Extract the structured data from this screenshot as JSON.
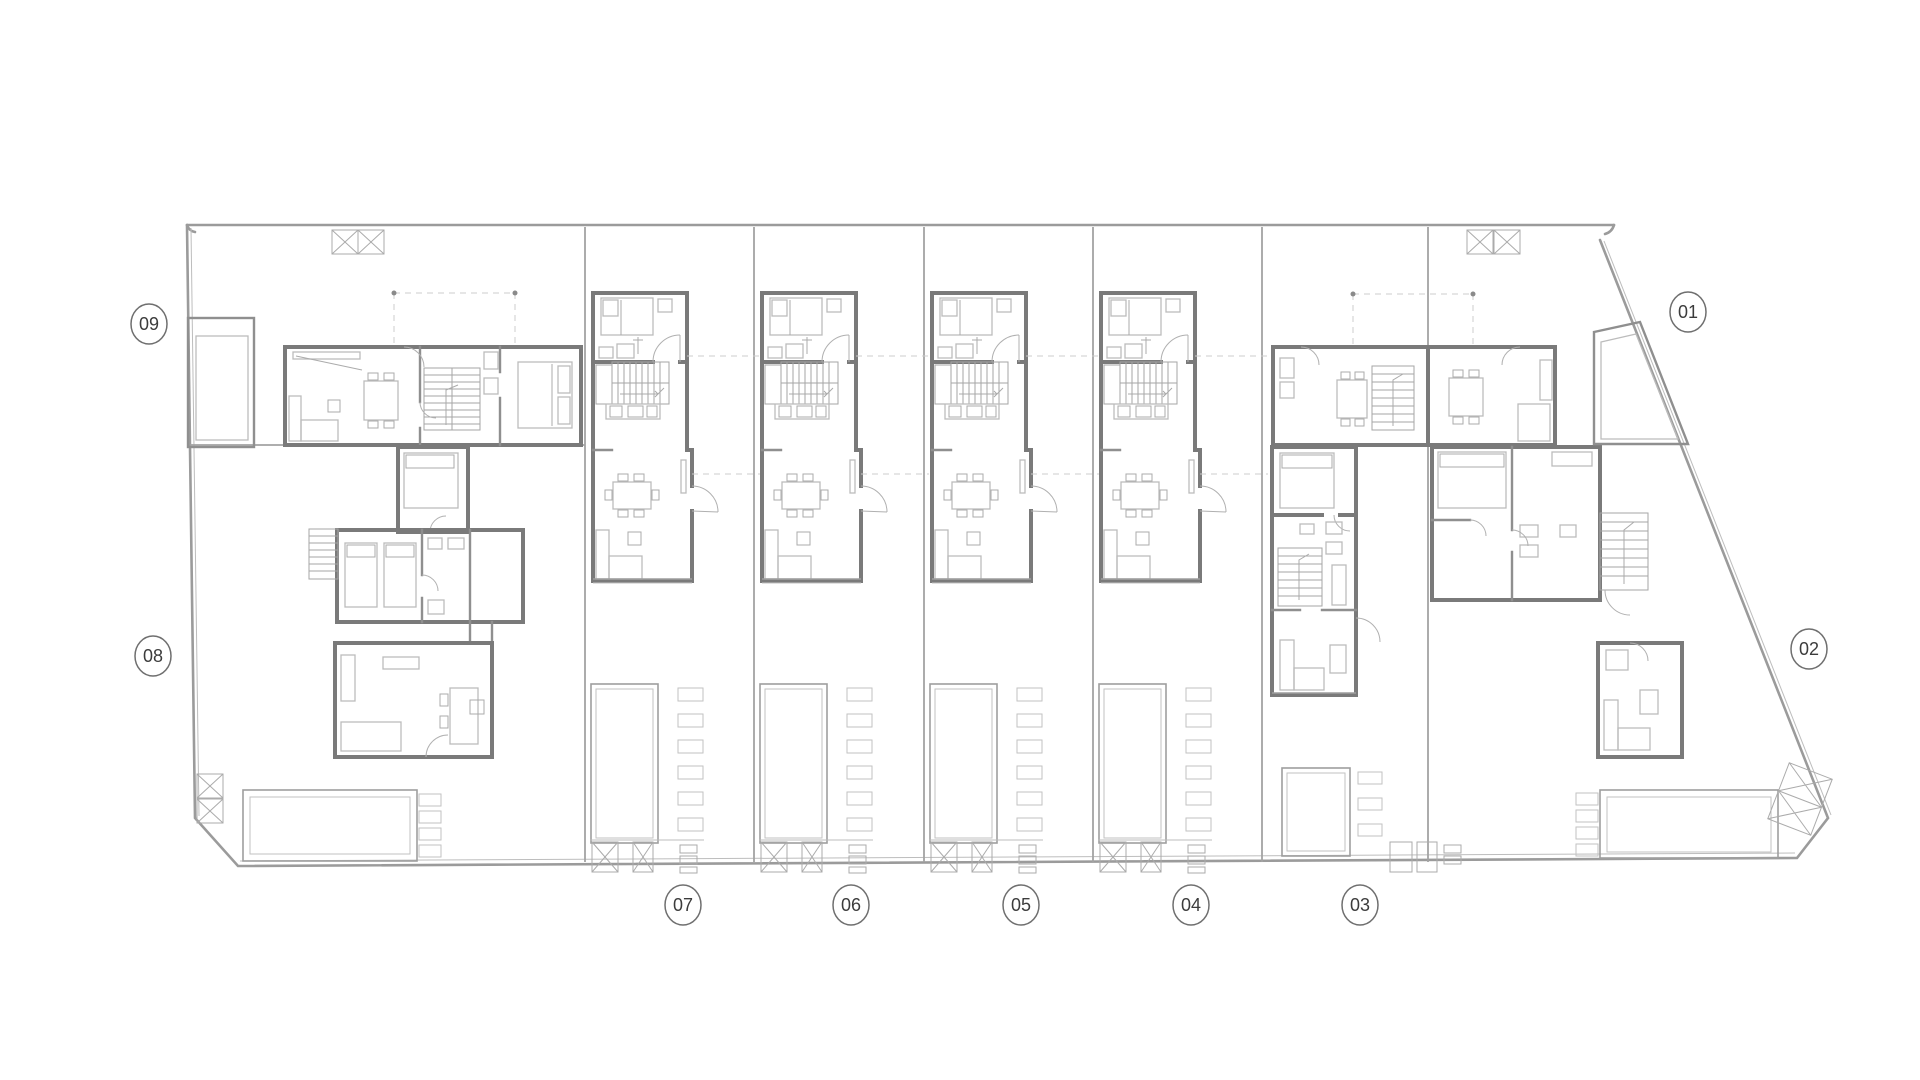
{
  "plan": {
    "type": "architectural-floor-plan",
    "units": [
      {
        "id": "unit-01",
        "label": "01"
      },
      {
        "id": "unit-02",
        "label": "02"
      },
      {
        "id": "unit-03",
        "label": "03"
      },
      {
        "id": "unit-04",
        "label": "04"
      },
      {
        "id": "unit-05",
        "label": "05"
      },
      {
        "id": "unit-06",
        "label": "06"
      },
      {
        "id": "unit-07",
        "label": "07"
      },
      {
        "id": "unit-08",
        "label": "08"
      },
      {
        "id": "unit-09",
        "label": "09"
      }
    ]
  },
  "colors": {
    "background": "#ffffff",
    "wall": "#7a7a7a",
    "boundary": "#9b9b9b",
    "furniture": "#bcbcbc",
    "label_stroke": "#6f6f6f",
    "label_text": "#3c3c3c"
  }
}
